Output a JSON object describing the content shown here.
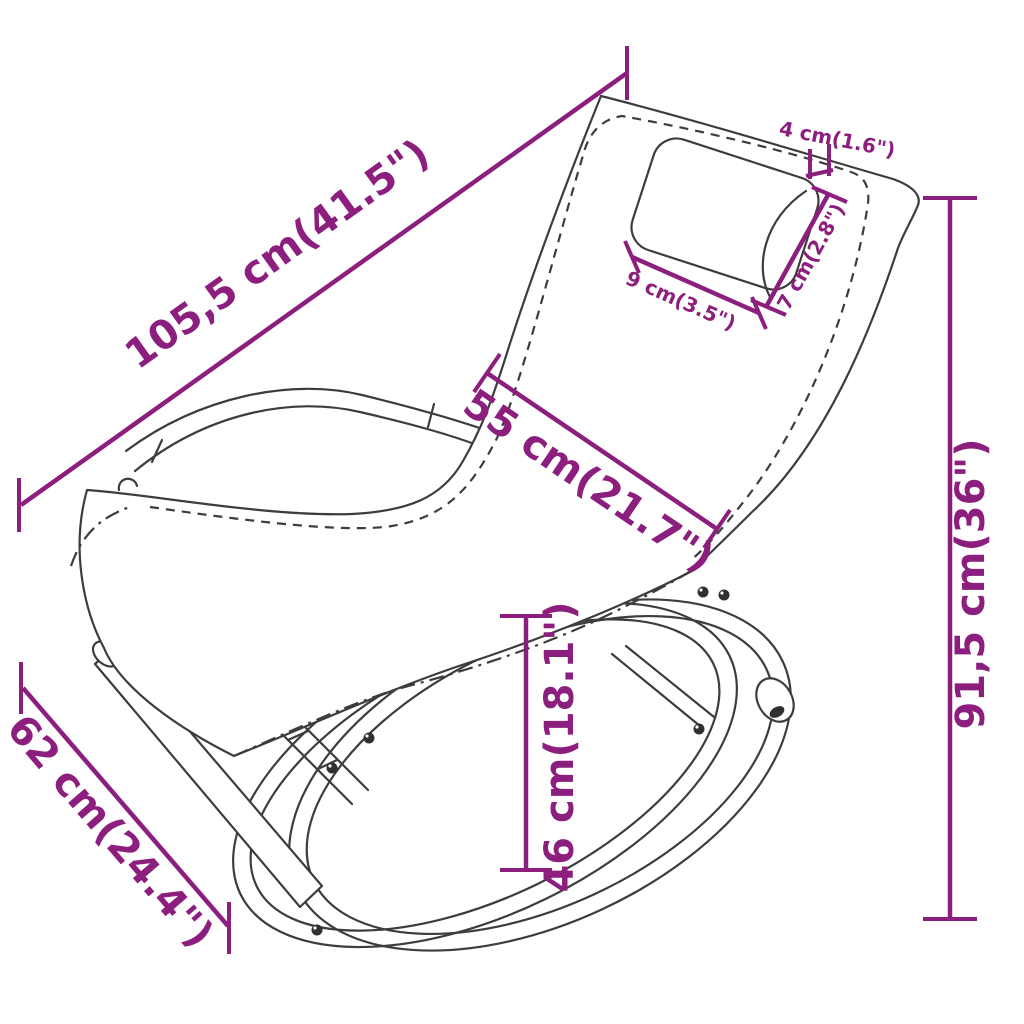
{
  "diagram": {
    "title": "rocking-sun-lounger-dimension-diagram",
    "accent_color": "#8c1e7e",
    "line_color": "#3d3d3d",
    "background_color": "#ffffff",
    "dims": {
      "total_length": {
        "label": "105,5 cm(41.5\")"
      },
      "backrest_width": {
        "label": "55 cm(21.7\")"
      },
      "pillow_gap": {
        "label": "4 cm(1.6\")"
      },
      "pillow_height": {
        "label": "7 cm(2.8\")"
      },
      "pillow_width": {
        "label": "9 cm(3.5\")"
      },
      "total_height": {
        "label": "91,5 cm(36\")"
      },
      "seat_height": {
        "label": "46 cm(18.1\")"
      },
      "base_depth": {
        "label": "62 cm(24.4\")"
      }
    }
  }
}
